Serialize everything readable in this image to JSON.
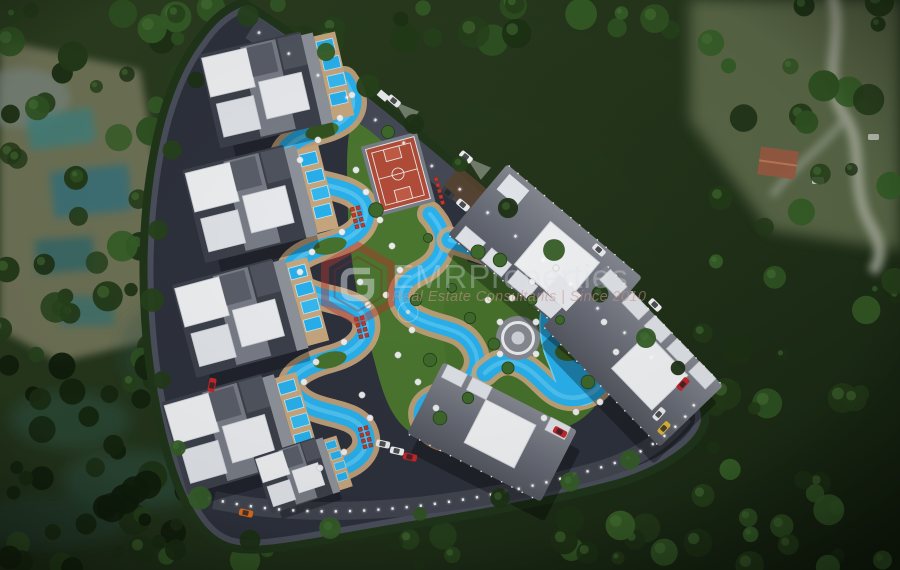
{
  "image": {
    "type": "aerial-3d-site-plan-render",
    "description": "Top-down 3D architectural rendering of a triangular gated residential resort complex surrounded by dense forest: white-roofed villa blocks with private pools on the left, winding turquoise lagoon pools and a lazy river through landscaped gardens, a basketball court, a circular plaza, three large apartment blocks on the right, parked cars and illuminated perimeter walls"
  },
  "watermark": {
    "brand": "EMRProperties",
    "tagline": "Real Estate Consultants | Since 2010",
    "logo": "red-hexagon-monogram"
  },
  "scene_features": [
    "forest-surroundings",
    "triangular-perimeter-wall",
    "perimeter-road",
    "villa-blocks-with-private-pools",
    "snaking-lagoon-pool",
    "lazy-river-pool",
    "basketball-court",
    "circular-plaza",
    "gazebo",
    "apartment-blocks",
    "sun-loungers",
    "parasols",
    "parked-cars",
    "street-lights"
  ],
  "palette": {
    "forest_dark": "#1b2c15",
    "forest_light": "#3c6530",
    "site_ground": "#2d313c",
    "road_gray": "#454956",
    "roof_white": "#edeff1",
    "building_gray": "#6a6e78",
    "pool_blue": "#29b0ec",
    "pool_highlight": "#6fd2f6",
    "deck_tan": "#c6a67e",
    "lawn_green": "#4a752f",
    "court_red": "#b14c38",
    "logo_red": "#b5342c",
    "car_red": "#c4262a",
    "car_orange": "#d96a1e",
    "car_yellow": "#d8b43a"
  }
}
